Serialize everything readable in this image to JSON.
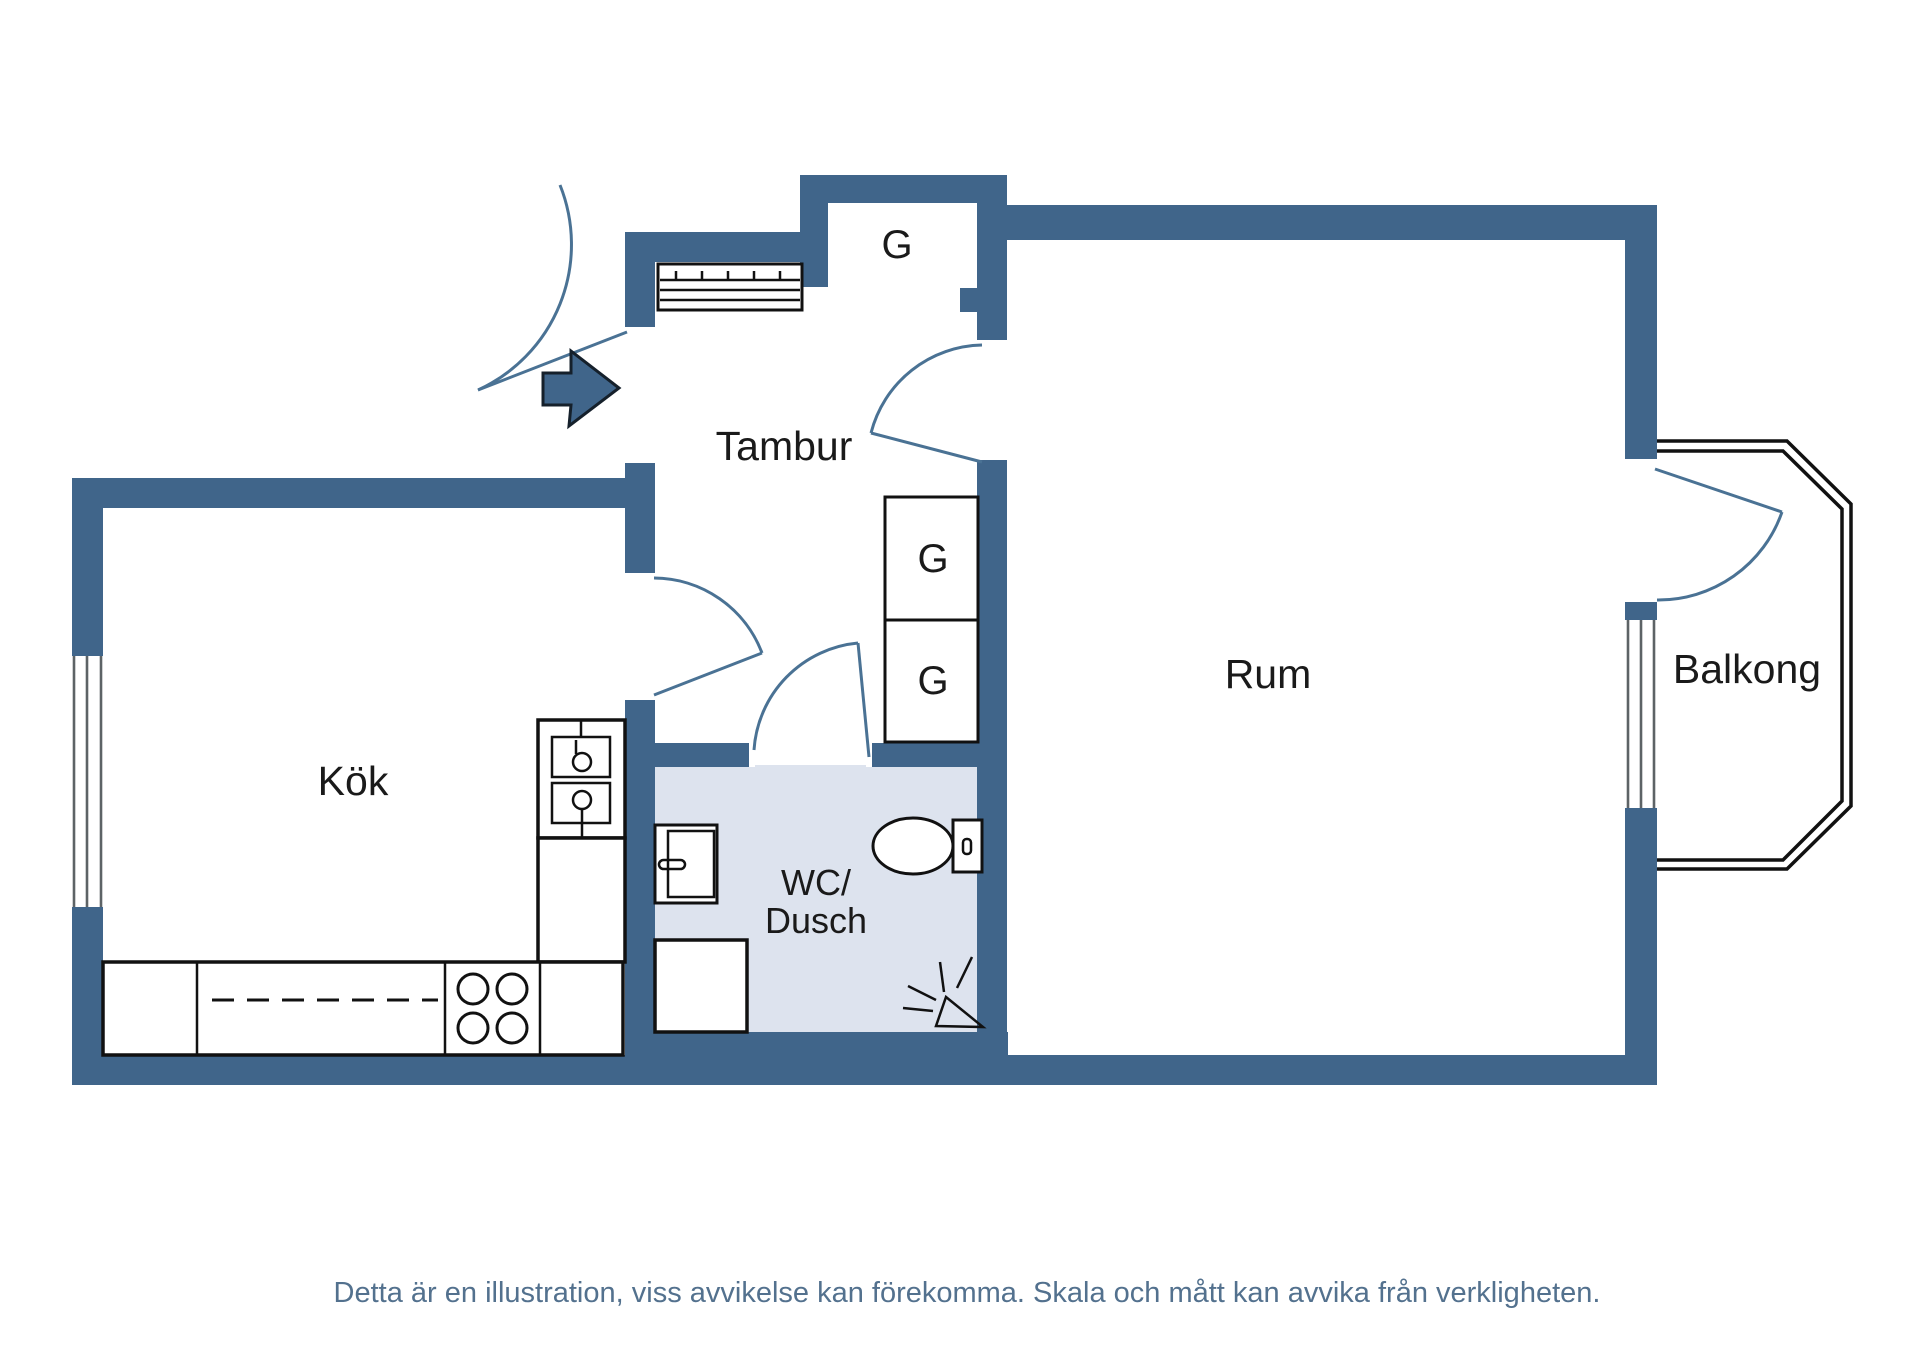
{
  "plan": {
    "type": "floorplan",
    "rooms": {
      "hallway": "Tambur",
      "kitchen": "Kök",
      "bathroom_line1": "WC/",
      "bathroom_line2": "Dusch",
      "room": "Rum",
      "balcony": "Balkong"
    },
    "closets": {
      "entry": "G",
      "upper": "G",
      "lower": "G"
    },
    "caption": "Detta är en illustration, viss avvikelse kan förekomma. Skala och mått kan avvika från verkligheten.",
    "colors": {
      "wall": "#40658A",
      "bathroom_floor": "#DDE3EE",
      "door_arc": "#4A7294",
      "outline": "#111111",
      "caption_text": "#53718E",
      "background": "#FFFFFF"
    },
    "symbols": [
      "entrance-arrow",
      "hat-shelf",
      "fridge-freezer",
      "kitchen-counter",
      "stove-burners",
      "sink",
      "toilet",
      "shower",
      "shower-spray",
      "window",
      "door-swing"
    ]
  }
}
